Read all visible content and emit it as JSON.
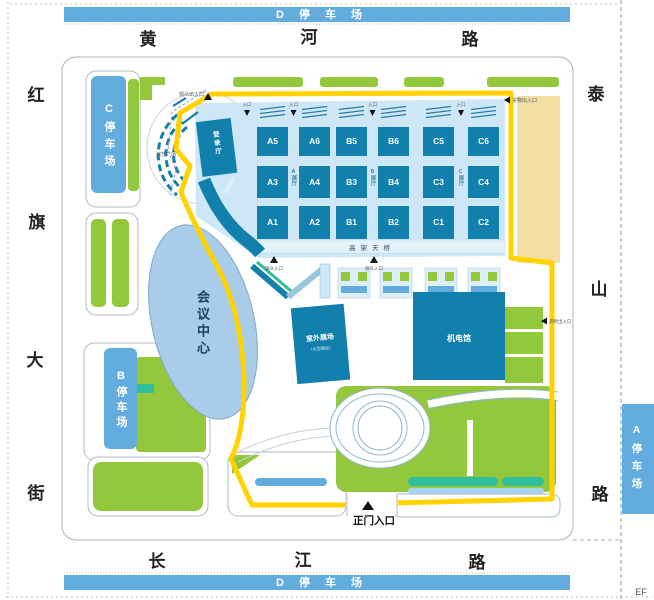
{
  "title_bars": {
    "top": "D 停 车 场",
    "bottom": "D 停 车 场"
  },
  "roads": {
    "north": [
      "黄",
      "河",
      "路"
    ],
    "south": [
      "长",
      "江",
      "路"
    ],
    "west": [
      "红",
      "旗",
      "大",
      "街"
    ],
    "east": [
      "泰",
      "山",
      "路"
    ]
  },
  "parking": {
    "a": "A停车场",
    "b": "B停车场",
    "c": "C停车场"
  },
  "halls": {
    "rows": [
      [
        "A5",
        "A6",
        "B5",
        "B6",
        "C5",
        "C6"
      ],
      [
        "A3",
        "A4",
        "B3",
        "B4",
        "C3",
        "C4"
      ],
      [
        "A1",
        "A2",
        "B1",
        "B2",
        "C1",
        "C2"
      ]
    ],
    "wings": [
      "A展厅",
      "B展厅",
      "C展厅"
    ],
    "skybridge": "高架天桥"
  },
  "buildings": {
    "conference": "会议中心",
    "outdoor": "室外展场",
    "outdoor_note": "（大型展品）",
    "electro": "机电馆",
    "registration": "登录厅",
    "escalator": "自动扶梯",
    "plaza": "演艺广场"
  },
  "entrances": {
    "main": "正门入口",
    "nw": "观众出入口",
    "ne": "货物出入口",
    "east": "货物出入口",
    "south_a": "观众入口",
    "south_b": "观众入口",
    "gate": "入口"
  },
  "corner": "EF",
  "colors": {
    "parking_blue": "#63ACDE",
    "hall_teal": "#1180AC",
    "green": "#93C83D",
    "teal_accent": "#2FBF9B",
    "route_yellow": "#FFD200",
    "platform_blue": "#CDE7F6",
    "oval_blue": "#A9CDE9",
    "beige": "#F4DFA3"
  }
}
